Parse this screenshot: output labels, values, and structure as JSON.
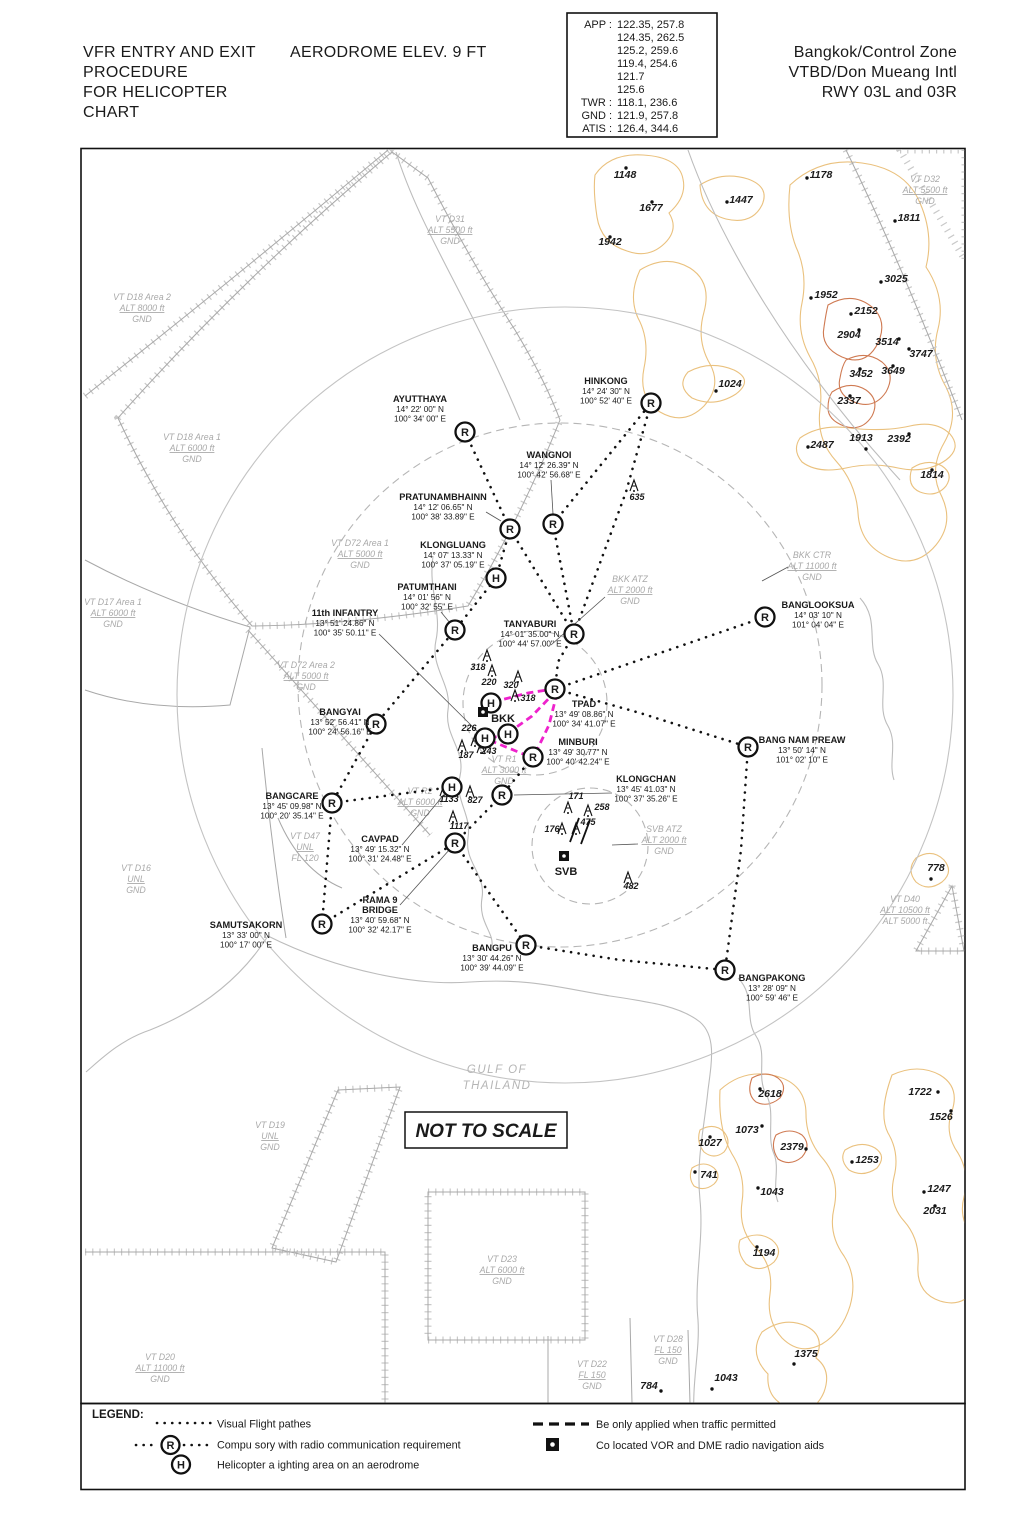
{
  "header": {
    "title_left": [
      "VFR ENTRY AND EXIT",
      "PROCEDURE",
      "FOR HELICOPTER",
      "CHART"
    ],
    "aerodrome_elev": "AERODROME ELEV. 9 FT",
    "title_right": [
      "Bangkok/Control Zone",
      "VTBD/Don Mueang Intl",
      "RWY 03L and 03R"
    ],
    "frequencies": [
      {
        "label": "APP :",
        "value": "122.35, 257.8"
      },
      {
        "label": "",
        "value": "124.35, 262.5"
      },
      {
        "label": "",
        "value": "125.2, 259.6"
      },
      {
        "label": "",
        "value": "119.4, 254.6"
      },
      {
        "label": "",
        "value": "121.7"
      },
      {
        "label": "",
        "value": "125.6"
      },
      {
        "label": "TWR :",
        "value": "118.1, 236.6"
      },
      {
        "label": "GND :",
        "value": "121.9, 257.8"
      },
      {
        "label": "ATIS :",
        "value": "126.4, 344.6"
      }
    ]
  },
  "map": {
    "not_to_scale": "NOT TO SCALE",
    "gulf": [
      "GULF OF",
      "THAILAND"
    ],
    "waypoints": [
      {
        "name": [
          "AYUTTHAYA"
        ],
        "lat": "14° 22' 00\" N",
        "lon": "100° 34' 00\" E",
        "sym": "R",
        "sx": 465,
        "sy": 432,
        "tx": 420,
        "ty": 402
      },
      {
        "name": [
          "HINKONG"
        ],
        "lat": "14° 24' 30\" N",
        "lon": "100° 52' 40\" E",
        "sym": "R",
        "sx": 651,
        "sy": 403,
        "tx": 606,
        "ty": 384
      },
      {
        "name": [
          "WANGNOI"
        ],
        "lat": "14° 12' 26.39\" N",
        "lon": "100° 42' 56.68\" E",
        "sym": "R",
        "sx": 553,
        "sy": 524,
        "tx": 549,
        "ty": 458
      },
      {
        "name": [
          "PRATUNAMBHAINN"
        ],
        "lat": "14° 12' 06.65\" N",
        "lon": "100° 38' 33.89\" E",
        "sym": "R",
        "sx": 510,
        "sy": 529,
        "tx": 443,
        "ty": 500
      },
      {
        "name": [
          "KLONGLUANG"
        ],
        "lat": "14° 07' 13.33\" N",
        "lon": "100° 37' 05.19\" E",
        "sym": "H",
        "sx": 496,
        "sy": 578,
        "tx": 453,
        "ty": 548
      },
      {
        "name": [
          "PATUMTHANI"
        ],
        "lat": "14° 01' 56\" N",
        "lon": "100° 32' 55\" E",
        "sym": "R",
        "sx": 455,
        "sy": 630,
        "tx": 427,
        "ty": 590
      },
      {
        "name": [
          "11th INFANTRY"
        ],
        "lat": "13° 51' 24.86\" N",
        "lon": "100° 35' 50.11\" E",
        "sym": "",
        "sx": 0,
        "sy": 0,
        "tx": 345,
        "ty": 616
      },
      {
        "name": [
          "TANYABURI"
        ],
        "lat": "14° 01' 35.00\" N",
        "lon": "100° 44' 57.00\" E",
        "sym": "R",
        "sx": 574,
        "sy": 634,
        "tx": 530,
        "ty": 627
      },
      {
        "name": [
          "BANGLOOKSUA"
        ],
        "lat": "14° 03' 10\" N",
        "lon": "101° 04' 04\" E",
        "sym": "R",
        "sx": 765,
        "sy": 617,
        "tx": 818,
        "ty": 608
      },
      {
        "name": [
          "BANGYAI"
        ],
        "lat": "13° 52' 56.41\" N",
        "lon": "100° 24' 56.16\" E",
        "sym": "R",
        "sx": 376,
        "sy": 724,
        "tx": 340,
        "ty": 715
      },
      {
        "name": [
          "TPAD"
        ],
        "lat": "13° 49' 08.86\" N",
        "lon": "100° 34' 41.07\" E",
        "sym": "R",
        "sx": 555,
        "sy": 689,
        "tx": 584,
        "ty": 707
      },
      {
        "name": [
          "MINBURI"
        ],
        "lat": "13° 49' 30.77\" N",
        "lon": "100° 40' 42.24\" E",
        "sym": "R",
        "sx": 533,
        "sy": 757,
        "tx": 578,
        "ty": 745
      },
      {
        "name": [
          "KLONGCHAN"
        ],
        "lat": "13° 45' 41.03\" N",
        "lon": "100° 37' 35.26\" E",
        "sym": "R",
        "sx": 502,
        "sy": 795,
        "tx": 646,
        "ty": 782
      },
      {
        "name": [
          "BANG NAM PREAW"
        ],
        "lat": "13° 50' 14\" N",
        "lon": "101° 02' 10\" E",
        "sym": "R",
        "sx": 748,
        "sy": 747,
        "tx": 802,
        "ty": 743
      },
      {
        "name": [
          "BANGCARE"
        ],
        "lat": "13° 45' 09.98\" N",
        "lon": "100° 20' 35.14\" E",
        "sym": "R",
        "sx": 332,
        "sy": 803,
        "tx": 292,
        "ty": 799
      },
      {
        "name": [
          "CAVPAD"
        ],
        "lat": "13° 49' 15.32\" N",
        "lon": "100° 31' 24.48\" E",
        "sym": "H",
        "sx": 452,
        "sy": 787,
        "tx": 380,
        "ty": 842
      },
      {
        "name": [
          "RAMA 9",
          "BRIDGE"
        ],
        "lat": "13° 40' 59.68\" N",
        "lon": "100° 32' 42.17\" E",
        "sym": "R",
        "sx": 455,
        "sy": 843,
        "tx": 380,
        "ty": 903
      },
      {
        "name": [
          "SAMUTSAKORN"
        ],
        "lat": "13° 33' 00\" N",
        "lon": "100° 17' 00\" E",
        "sym": "R",
        "sx": 322,
        "sy": 924,
        "tx": 246,
        "ty": 928
      },
      {
        "name": [
          "BANGPU"
        ],
        "lat": "13° 30' 44.26\" N",
        "lon": "100° 39' 44.09\" E",
        "sym": "R",
        "sx": 526,
        "sy": 945,
        "tx": 492,
        "ty": 951
      },
      {
        "name": [
          "BANGPAKONG"
        ],
        "lat": "13° 28' 09\" N",
        "lon": "100° 59' 46\" E",
        "sym": "R",
        "sx": 725,
        "sy": 970,
        "tx": 772,
        "ty": 981
      }
    ],
    "helipads": [
      [
        491,
        703
      ],
      [
        508,
        734
      ],
      [
        485,
        738
      ]
    ],
    "navaids": [
      {
        "id": "BKK",
        "sx": 483,
        "sy": 712,
        "tx": 503,
        "ty": 722
      },
      {
        "id": "SVB",
        "sx": 564,
        "sy": 856,
        "tx": 566,
        "ty": 875
      }
    ],
    "areas": [
      [
        450,
        222,
        [
          "VT D31",
          "ALT 5500 ft",
          "GND"
        ]
      ],
      [
        925,
        182,
        [
          "VT D32",
          "ALT 5500 ft",
          "GND"
        ]
      ],
      [
        142,
        300,
        [
          "VT D18 Area 2",
          "ALT 8000 ft",
          "GND"
        ]
      ],
      [
        192,
        440,
        [
          "VT D18 Area 1",
          "ALT 6000 ft",
          "GND"
        ]
      ],
      [
        113,
        605,
        [
          "VT D17 Area 1",
          "ALT 6000 ft",
          "GND"
        ]
      ],
      [
        360,
        546,
        [
          "VT D72 Area 1",
          "ALT 5000 ft",
          "GND"
        ]
      ],
      [
        306,
        668,
        [
          "VT D72 Area 2",
          "ALT 5000 ft",
          "GND"
        ]
      ],
      [
        812,
        558,
        [
          "BKK CTR",
          "ALT 11000 ft",
          "GND"
        ]
      ],
      [
        630,
        582,
        [
          "BKK ATZ",
          "ALT 2000 ft",
          "GND"
        ]
      ],
      [
        136,
        871,
        [
          "VT D16",
          "UNL",
          "GND"
        ]
      ],
      [
        305,
        839,
        [
          "VT D47",
          "UNL",
          "FL 120"
        ]
      ],
      [
        420,
        794,
        [
          "VT R2",
          "ALT 6000 ft",
          "GND"
        ]
      ],
      [
        504,
        762,
        [
          "VT R1",
          "ALT 3000 ft",
          "GND"
        ]
      ],
      [
        664,
        832,
        [
          "SVB ATZ",
          "ALT 2000 ft",
          "GND"
        ]
      ],
      [
        270,
        1128,
        [
          "VT D19",
          "UNL",
          "GND"
        ]
      ],
      [
        160,
        1360,
        [
          "VT D20",
          "ALT 11000 ft",
          "GND"
        ]
      ],
      [
        592,
        1367,
        [
          "VT D22",
          "FL 150",
          "GND"
        ]
      ],
      [
        502,
        1262,
        [
          "VT D23",
          "ALT 6000 ft",
          "GND"
        ]
      ],
      [
        668,
        1342,
        [
          "VT D28",
          "FL 150",
          "GND"
        ]
      ],
      [
        905,
        902,
        [
          "VT D40",
          "ALT 10500 ft",
          "ALT 5000 ft"
        ]
      ]
    ],
    "spot_elevations": [
      [
        "1148",
        625,
        178,
        626,
        168
      ],
      [
        "1677",
        651,
        211,
        652,
        202
      ],
      [
        "1942",
        610,
        245,
        610,
        237
      ],
      [
        "1447",
        741,
        203,
        727,
        202
      ],
      [
        "1178",
        821,
        178,
        807,
        178
      ],
      [
        "1811",
        909,
        221,
        895,
        221
      ],
      [
        "3025",
        896,
        282,
        881,
        282
      ],
      [
        "1952",
        826,
        298,
        811,
        298
      ],
      [
        "2152",
        866,
        314,
        851,
        314
      ],
      [
        "2904",
        849,
        338,
        859,
        330
      ],
      [
        "3514",
        887,
        345,
        899,
        339
      ],
      [
        "3747",
        921,
        357,
        909,
        349
      ],
      [
        "3452",
        861,
        377,
        860,
        369
      ],
      [
        "3649",
        893,
        374,
        893,
        366
      ],
      [
        "1024",
        730,
        387,
        716,
        391
      ],
      [
        "2337",
        849,
        404,
        850,
        396
      ],
      [
        "2487",
        822,
        448,
        808,
        447
      ],
      [
        "1913",
        861,
        441,
        866,
        449
      ],
      [
        "2392",
        899,
        442,
        909,
        434
      ],
      [
        "1814",
        932,
        478,
        932,
        470
      ],
      [
        "778",
        936,
        871,
        931,
        879
      ],
      [
        "2618",
        770,
        1097,
        760,
        1089
      ],
      [
        "1722",
        920,
        1095,
        938,
        1092
      ],
      [
        "1526",
        941,
        1120,
        951,
        1111
      ],
      [
        "1073",
        747,
        1133,
        762,
        1126
      ],
      [
        "1027",
        710,
        1146,
        710,
        1137
      ],
      [
        "2379",
        792,
        1150,
        806,
        1149
      ],
      [
        "1253",
        867,
        1163,
        852,
        1162
      ],
      [
        "741",
        709,
        1178,
        695,
        1172
      ],
      [
        "1043",
        772,
        1195,
        758,
        1188
      ],
      [
        "1247",
        939,
        1192,
        924,
        1192
      ],
      [
        "2031",
        935,
        1214,
        935,
        1206
      ],
      [
        "1194",
        764,
        1256,
        757,
        1247
      ],
      [
        "1375",
        806,
        1357,
        794,
        1364
      ],
      [
        "1043",
        726,
        1381,
        712,
        1389
      ],
      [
        "784",
        649,
        1389,
        661,
        1391
      ]
    ],
    "obstacles": [
      [
        "635",
        637,
        500,
        634,
        486
      ],
      [
        "318",
        478,
        670,
        487,
        656
      ],
      [
        "220",
        489,
        685,
        492,
        671
      ],
      [
        "320",
        511,
        688,
        518,
        677
      ],
      [
        "318",
        528,
        701,
        515,
        696
      ],
      [
        "226",
        469,
        731,
        475,
        741
      ],
      [
        "243",
        489,
        754,
        481,
        748
      ],
      [
        "187",
        466,
        758,
        462,
        746
      ],
      [
        "1133",
        449,
        802,
        444,
        791
      ],
      [
        "827",
        475,
        803,
        470,
        792
      ],
      [
        "1117",
        459,
        829,
        453,
        817
      ],
      [
        "171",
        576,
        799,
        568,
        808
      ],
      [
        "258",
        602,
        810,
        588,
        811
      ],
      [
        "475",
        588,
        825,
        576,
        829
      ],
      [
        "176",
        552,
        832,
        562,
        829
      ],
      [
        "482",
        631,
        889,
        628,
        878
      ]
    ],
    "routes": [
      [
        [
          465,
          432
        ],
        [
          510,
          529
        ]
      ],
      [
        [
          510,
          529
        ],
        [
          496,
          578
        ],
        [
          455,
          630
        ],
        [
          376,
          724
        ],
        [
          332,
          803
        ]
      ],
      [
        [
          332,
          803
        ],
        [
          322,
          924
        ]
      ],
      [
        [
          553,
          524
        ],
        [
          651,
          403
        ]
      ],
      [
        [
          553,
          524
        ],
        [
          574,
          634
        ]
      ],
      [
        [
          510,
          529
        ],
        [
          574,
          634
        ]
      ],
      [
        [
          651,
          403
        ],
        [
          626,
          492
        ],
        [
          574,
          634
        ]
      ],
      [
        [
          574,
          634
        ],
        [
          558,
          662
        ],
        [
          555,
          689
        ]
      ],
      [
        [
          555,
          689
        ],
        [
          765,
          617
        ]
      ],
      [
        [
          555,
          689
        ],
        [
          640,
          713
        ],
        [
          748,
          747
        ]
      ],
      [
        [
          748,
          747
        ],
        [
          741,
          850
        ],
        [
          729,
          940
        ],
        [
          725,
          970
        ]
      ],
      [
        [
          526,
          945
        ],
        [
          620,
          960
        ],
        [
          725,
          970
        ]
      ],
      [
        [
          455,
          843
        ],
        [
          492,
          897
        ],
        [
          526,
          945
        ]
      ],
      [
        [
          322,
          924
        ],
        [
          455,
          843
        ]
      ],
      [
        [
          332,
          803
        ],
        [
          452,
          787
        ]
      ],
      [
        [
          533,
          757
        ],
        [
          502,
          795
        ]
      ],
      [
        [
          502,
          795
        ],
        [
          455,
          843
        ]
      ]
    ],
    "permitted_routes": [
      [
        [
          493,
          702
        ],
        [
          528,
          693
        ],
        [
          553,
          689
        ]
      ],
      [
        [
          556,
          691
        ],
        [
          532,
          716
        ],
        [
          511,
          731
        ]
      ],
      [
        [
          508,
          735
        ],
        [
          488,
          738
        ]
      ],
      [
        [
          557,
          693
        ],
        [
          549,
          725
        ],
        [
          536,
          752
        ]
      ],
      [
        [
          528,
          756
        ],
        [
          489,
          740
        ]
      ]
    ],
    "leaders": [
      [
        551,
        480,
        553,
        514
      ],
      [
        486,
        512,
        501,
        521
      ],
      [
        441,
        612,
        450,
        623
      ],
      [
        379,
        634,
        478,
        732
      ],
      [
        612,
        793,
        514,
        795
      ],
      [
        402,
        845,
        447,
        791
      ],
      [
        400,
        905,
        450,
        849
      ],
      [
        605,
        597,
        551,
        645
      ],
      [
        762,
        581,
        788,
        567
      ],
      [
        638,
        844,
        612,
        845
      ]
    ]
  },
  "legend": {
    "title": "LEGEND:",
    "items_left": [
      {
        "symbol": "dotted-line",
        "text": "Visual Flight pathes"
      },
      {
        "symbol": "compulsory-point",
        "text": "Compu sory with radio communication requirement"
      },
      {
        "symbol": "helicopter-area",
        "text": "Helicopter a ighting area on an aerodrome"
      }
    ],
    "items_right": [
      {
        "symbol": "dashed-line",
        "text": "Be only applied when traffic permitted"
      },
      {
        "symbol": "vor-dme",
        "text": "Co located VOR and DME radio navigation aids"
      }
    ],
    "symbol_letters": {
      "compulsory": "R",
      "helipad": "H"
    }
  },
  "colors": {
    "permitted_route": "#ee22cc",
    "terrain_light": "#eac17e",
    "terrain_dark": "#cf7a52"
  }
}
